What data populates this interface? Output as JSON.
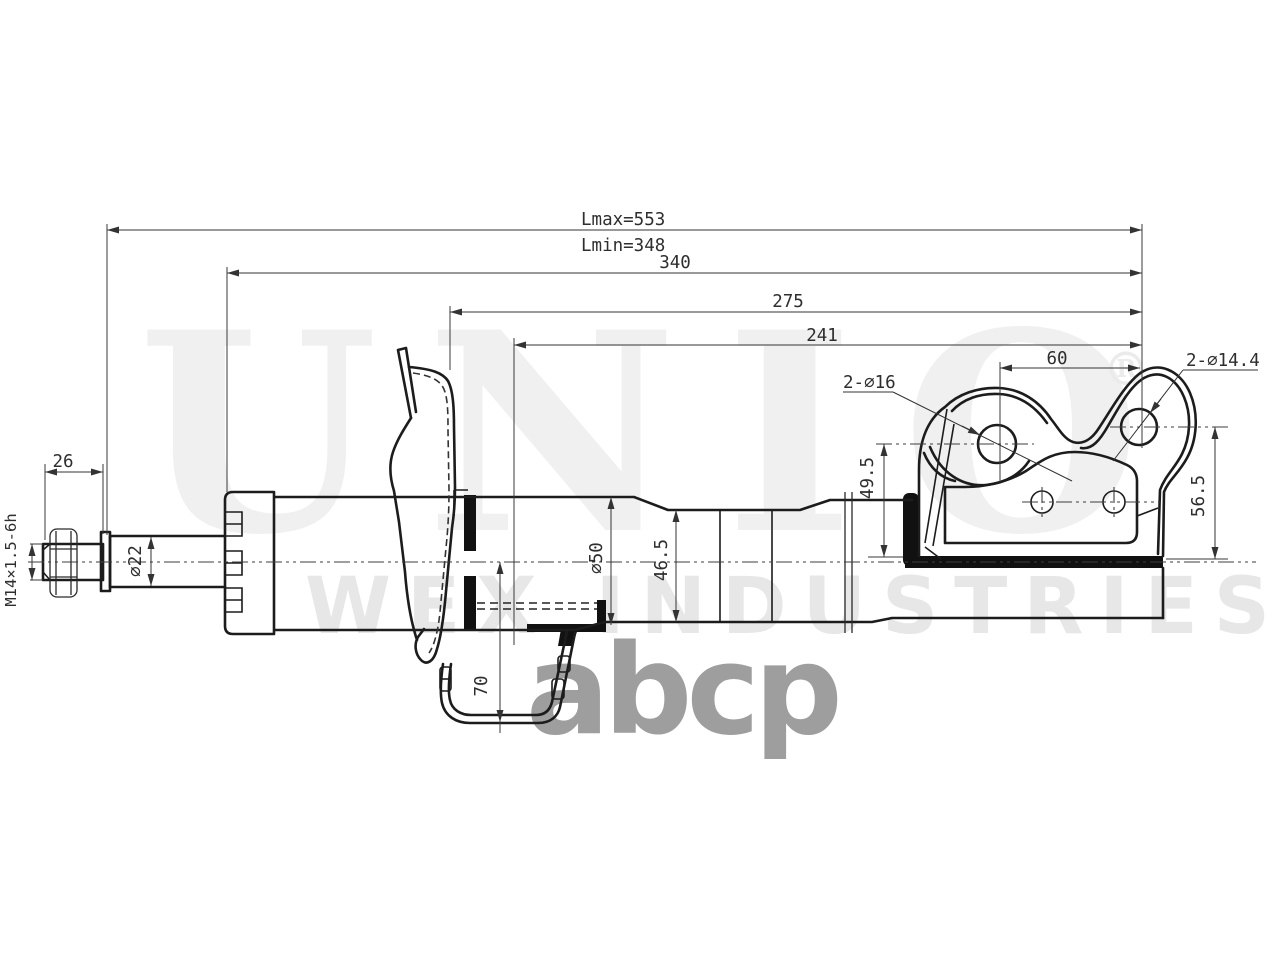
{
  "drawing": {
    "type": "shock-absorber-strut-technical-drawing",
    "dimensions": {
      "lmax": "Lmax=553",
      "lmin": "Lmin=348",
      "len_340": "340",
      "len_275": "275",
      "len_241": "241",
      "len_60": "60",
      "holes_upper": "2-∅16",
      "holes_lower": "2-∅14.4",
      "h_49_5": "49.5",
      "h_56_5": "56.5",
      "len_26": "26",
      "thread": "M14×1.5-6h",
      "rod_dia": "∅22",
      "body_dia": "∅50",
      "body_dia_small": "46.5",
      "h_70": "70"
    },
    "watermarks": {
      "brand": "UNIO",
      "registered": "®",
      "subtitle": "WEX INDUSTRIES",
      "logo": "abcp"
    },
    "colors": {
      "background": "#ffffff",
      "line": "#1c1c1c",
      "dimension": "#333333",
      "watermark_light": "#efefef",
      "watermark_logo": "#9e9e9e"
    }
  }
}
